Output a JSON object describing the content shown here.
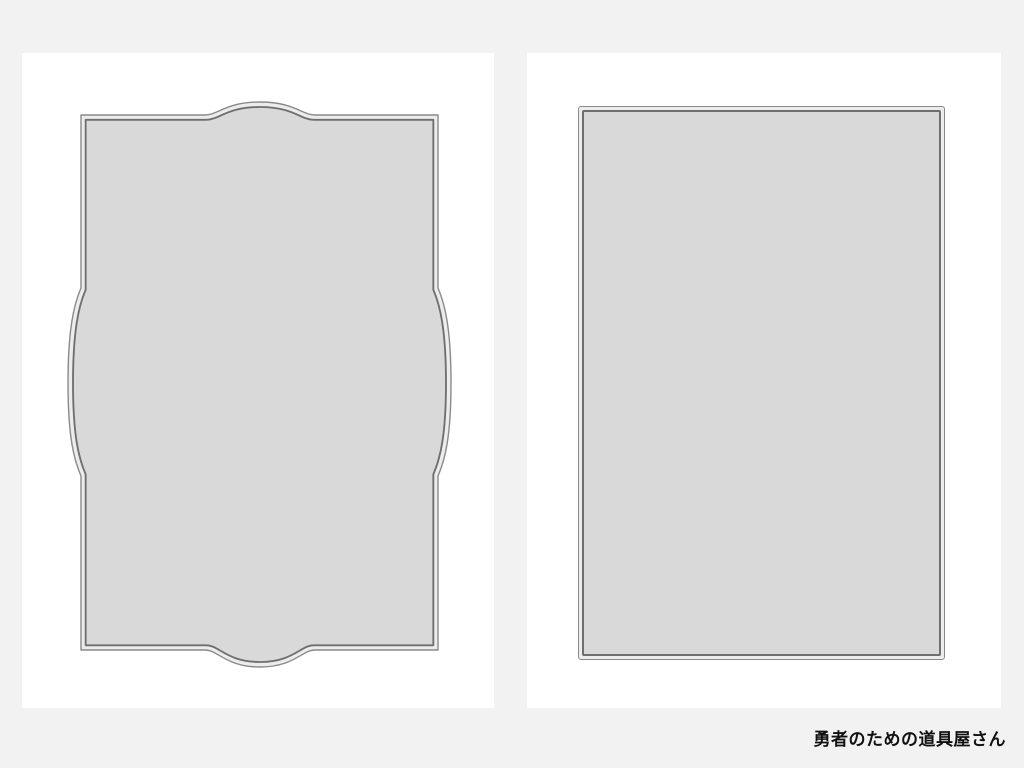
{
  "caption": {
    "text": "勇者のための道具屋さん"
  },
  "pages": [
    {
      "id": "left",
      "frame_style": "ornate-bracket-frame",
      "content": ""
    },
    {
      "id": "right",
      "frame_style": "double-border-rectangle-frame",
      "content": ""
    }
  ],
  "colors": {
    "background": "#f2f2f2",
    "page": "#ffffff",
    "frame_fill": "#d9d9d9",
    "frame_line_outer": "#8a8a8a",
    "frame_line_inner": "#6f6f6f",
    "frame_gap": "#ececec",
    "caption_text": "#111111"
  }
}
